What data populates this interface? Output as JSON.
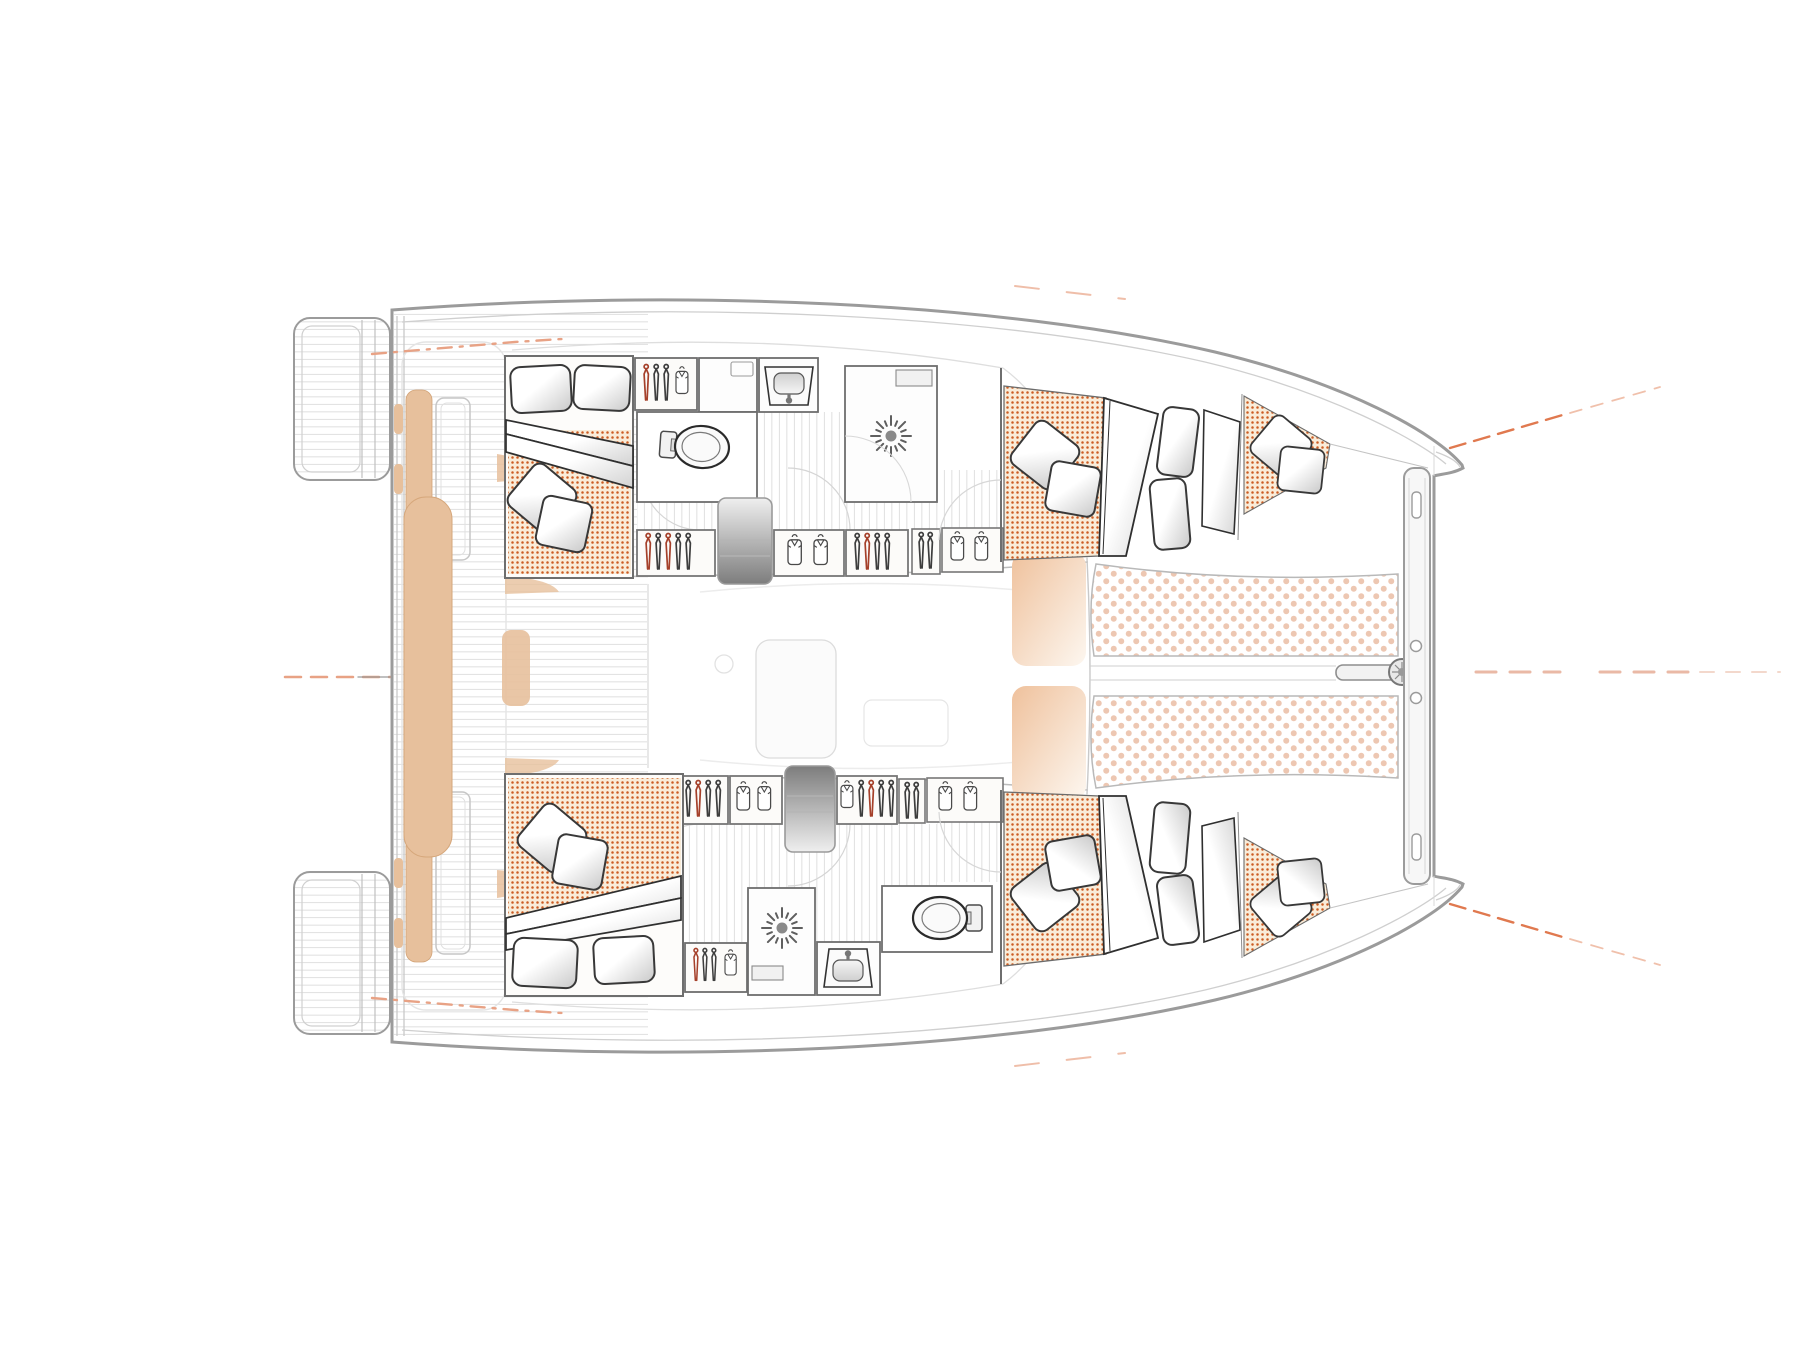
{
  "diagram": {
    "type": "catamaran-interior-floor-plan",
    "view": "top-down",
    "bow_direction": "right",
    "hulls": 2,
    "cabins": [
      {
        "name": "upper-hull-aft-cabin",
        "bed": "double",
        "pillows": 4,
        "mattress_texture": "orange-dot"
      },
      {
        "name": "upper-hull-forward-cabin",
        "bed": "double",
        "pillows": 6,
        "mattress_texture": "orange-dot"
      },
      {
        "name": "lower-hull-aft-cabin",
        "bed": "double",
        "pillows": 4,
        "mattress_texture": "orange-dot"
      },
      {
        "name": "lower-hull-forward-cabin",
        "bed": "double",
        "pillows": 6,
        "mattress_texture": "orange-dot"
      }
    ],
    "bathrooms": [
      {
        "name": "upper-hull-head",
        "fixtures": [
          "toilet",
          "sink",
          "shower-sunburst-drain"
        ]
      },
      {
        "name": "lower-hull-head",
        "fixtures": [
          "toilet",
          "sink",
          "shower-sunburst-drain"
        ]
      }
    ],
    "features": [
      "aft-swim-step-platforms",
      "aft-cockpit-teak-deck",
      "aft-bench-seats",
      "central-sunpad",
      "saloon",
      "companionway-stairs",
      "hanger-wardrobes",
      "shirt-lockers",
      "forward-seat-pods",
      "trampoline-two-panels",
      "bowsprit",
      "forward-crossbeam",
      "bow-tips"
    ],
    "counts": {
      "hanger_lockers": 8,
      "shirt_lockers": 5,
      "staircases": 2,
      "showers": 2,
      "toilets": 2,
      "sinks": 2,
      "trampoline_panels": 2,
      "forward_seat_pods": 2,
      "bench_seats": 2,
      "swim_platforms": 2,
      "hanger_glyphs": 27,
      "shirt_glyphs": 11
    }
  },
  "colors": {
    "hull_outline": "#9b9b9b",
    "inner_line": "#cfcfcf",
    "wall": "#6e6e6e",
    "plank": "#dcdcdc",
    "mattress_bg": "#f9ecd9",
    "mattress_dot": "#cc5c22",
    "trampoline_dot": "#edc7b2",
    "cushion": "#e7c09c",
    "peach_pad": "#efc19c",
    "accent_soft": "#e8a285",
    "accent_strong": "#e0794f",
    "accent_pink": "#eab9a6",
    "fixture": "#5f5f5f"
  }
}
